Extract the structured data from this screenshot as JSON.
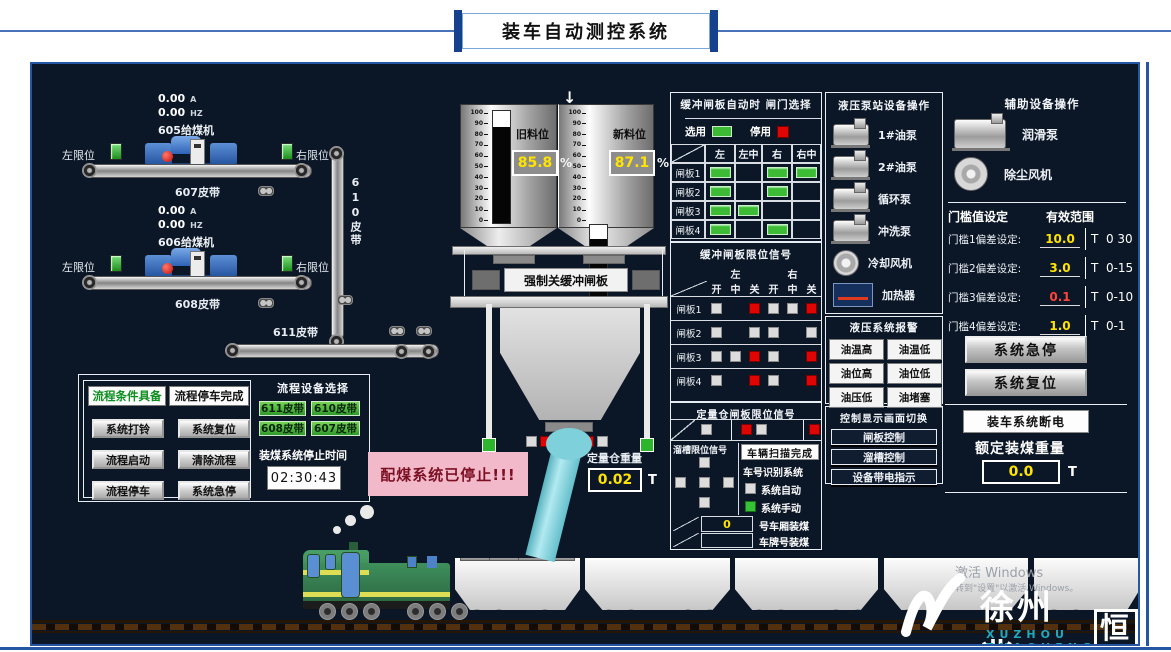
{
  "title": "装车自动测控系统",
  "colors": {
    "panel_bg": "#0b1626",
    "accent_blue": "#2456a4",
    "on_green": "#3dbb35",
    "alarm_red": "#e00505",
    "value_yellow": "#ffe400",
    "warn_pink": "#f2b9cb"
  },
  "feeders": [
    {
      "current": "0.00",
      "current_unit": "A",
      "freq": "0.00",
      "freq_unit": "HZ",
      "name": "605给煤机",
      "left_label": "左限位",
      "right_label": "右限位",
      "belt_label": "607皮带"
    },
    {
      "current": "0.00",
      "current_unit": "A",
      "freq": "0.00",
      "freq_unit": "HZ",
      "name": "606给煤机",
      "left_label": "左限位",
      "right_label": "右限位",
      "belt_label": "608皮带"
    }
  ],
  "belt610": "610皮带",
  "belt611": "611皮带",
  "hoppers": {
    "scale_ticks": [
      "100",
      "90",
      "80",
      "70",
      "60",
      "50",
      "40",
      "30",
      "20",
      "10",
      "0"
    ],
    "old": {
      "label": "旧料位",
      "value": "85.8",
      "unit": "%"
    },
    "new": {
      "label": "新料位",
      "value": "87.1",
      "unit": "%"
    }
  },
  "arrow": "↓",
  "force_close_label": "强制关缓冲闸板",
  "weigh_bin": {
    "label": "定量仓重量",
    "value": "0.02",
    "unit": "T"
  },
  "alarm_message": "配煤系统已停止!!!",
  "gate_select": {
    "title": "缓冲闸板自动时 闸门选择",
    "legend_on": "选用",
    "legend_off": "停用",
    "columns": [
      "左",
      "左中",
      "右",
      "右中"
    ],
    "rows": [
      {
        "label": "闸板1",
        "cells": [
          1,
          0,
          1,
          1
        ]
      },
      {
        "label": "闸板2",
        "cells": [
          1,
          0,
          1,
          0
        ]
      },
      {
        "label": "闸板3",
        "cells": [
          1,
          1,
          0,
          0
        ]
      },
      {
        "label": "闸板4",
        "cells": [
          1,
          0,
          1,
          0
        ]
      }
    ]
  },
  "limit_signal": {
    "title": "缓冲闸板限位信号",
    "groups": [
      "左",
      "右"
    ],
    "sub_columns": [
      "开",
      "中",
      "关",
      "开",
      "中",
      "关"
    ],
    "rows": [
      {
        "label": "闸板1",
        "cells": [
          "g",
          "",
          "r",
          "g",
          "g",
          "r"
        ]
      },
      {
        "label": "闸板2",
        "cells": [
          "g",
          "",
          "g",
          "g",
          "",
          "g"
        ]
      },
      {
        "label": "闸板3",
        "cells": [
          "g",
          "g",
          "r",
          "g",
          "",
          "r"
        ]
      },
      {
        "label": "闸板4",
        "cells": [
          "g",
          "",
          "r",
          "g",
          "",
          "r"
        ]
      }
    ]
  },
  "bin_limit": {
    "title": "定量仓闸板限位信号",
    "cells": [
      "g",
      "r",
      "g",
      "r"
    ]
  },
  "chute_limit": {
    "title": "溜槽限位信号",
    "top": "g",
    "middle": [
      "g",
      "g",
      "g"
    ],
    "bottom": "g"
  },
  "scan": {
    "scan_done": "车辆扫描完成",
    "id_system": "车号识别系统",
    "auto_label": "系统自动",
    "manual_label": "系统手动",
    "car_value": "0",
    "car_label": "号车厢装煤",
    "plate_label": "车牌号装煤"
  },
  "pump_station": {
    "title": "液压泵站设备操作",
    "items": [
      {
        "label": "1#油泵",
        "icon": "pump-icon"
      },
      {
        "label": "2#油泵",
        "icon": "pump-icon"
      },
      {
        "label": "循环泵",
        "icon": "pump-icon"
      },
      {
        "label": "冲洗泵",
        "icon": "pump-icon"
      },
      {
        "label": "冷却风机",
        "icon": "fan-icon"
      },
      {
        "label": "加热器",
        "icon": "heater-icon"
      }
    ]
  },
  "hydraulic_alarm": {
    "title": "液压系统报警",
    "items": [
      "油温高",
      "油温低",
      "油位高",
      "油位低",
      "油压低",
      "油堵塞"
    ]
  },
  "screen_switch": {
    "title": "控制显示画面切换",
    "items": [
      "闸板控制",
      "溜槽控制",
      "设备带电指示"
    ]
  },
  "aux": {
    "title": "辅助设备操作",
    "items": [
      {
        "label": "润滑泵",
        "icon": "pump-icon"
      },
      {
        "label": "除尘风机",
        "icon": "fan-icon"
      }
    ]
  },
  "threshold": {
    "title": "门槛值设定",
    "range_title": "有效范围",
    "rows": [
      {
        "label": "门槛1偏差设定:",
        "value": "10.0",
        "unit": "T",
        "range": "0 30",
        "color": "#ffe400"
      },
      {
        "label": "门槛2偏差设定:",
        "value": "3.0",
        "unit": "T",
        "range": "0-15",
        "color": "#ffe400"
      },
      {
        "label": "门槛3偏差设定:",
        "value": "0.1",
        "unit": "T",
        "range": "0-10",
        "color": "#ff4438"
      },
      {
        "label": "门槛4偏差设定:",
        "value": "1.0",
        "unit": "T",
        "range": "0-1",
        "color": "#ffe400"
      }
    ]
  },
  "system": {
    "estop": "系统急停",
    "reset": "系统复位",
    "power_off": "装车系统断电",
    "rated_label": "额定装煤重量",
    "rated_value": "0.0",
    "rated_unit": "T"
  },
  "process": {
    "status_ready": "流程条件具备",
    "status_stopped": "流程停车完成",
    "buttons": [
      "系统打铃",
      "系统复位",
      "流程启动",
      "清除流程",
      "流程停车",
      "系统急停"
    ],
    "select_title": "流程设备选择",
    "belts": [
      "611皮带",
      "610皮带",
      "608皮带",
      "607皮带"
    ],
    "stop_time_label": "装煤系统停止时间",
    "stop_time": "02:30:43"
  },
  "logo": {
    "cn_main": "徐州兆",
    "cn_last": "恒",
    "en": "XUZHOU ZHAOHENG"
  },
  "watermark": {
    "line1": "激活 Windows",
    "line2": "转到\"设置\"以激活 Windows。"
  }
}
